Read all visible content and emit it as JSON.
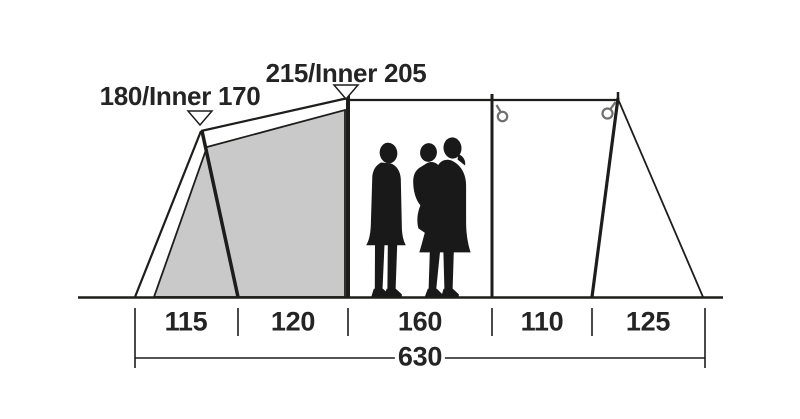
{
  "diagram": {
    "type": "tent-dimension-side-view",
    "height_labels": [
      {
        "text": "180/Inner 170"
      },
      {
        "text": "215/Inner 205"
      }
    ],
    "segment_dims": [
      {
        "text": "115"
      },
      {
        "text": "120"
      },
      {
        "text": "160"
      },
      {
        "text": "110"
      },
      {
        "text": "125"
      }
    ],
    "total_dim": {
      "text": "630"
    },
    "icons": {
      "height_marker": "triangle-down-icon",
      "pole_hook": "ring-hook-icon",
      "figures": "family-silhouette"
    },
    "colors": {
      "line": "#1d1d1b",
      "inner_tent_fill": "#c9c9c9",
      "ring_gray": "#6f6f6f",
      "silhouette": "#191919",
      "text": "#242424"
    }
  }
}
